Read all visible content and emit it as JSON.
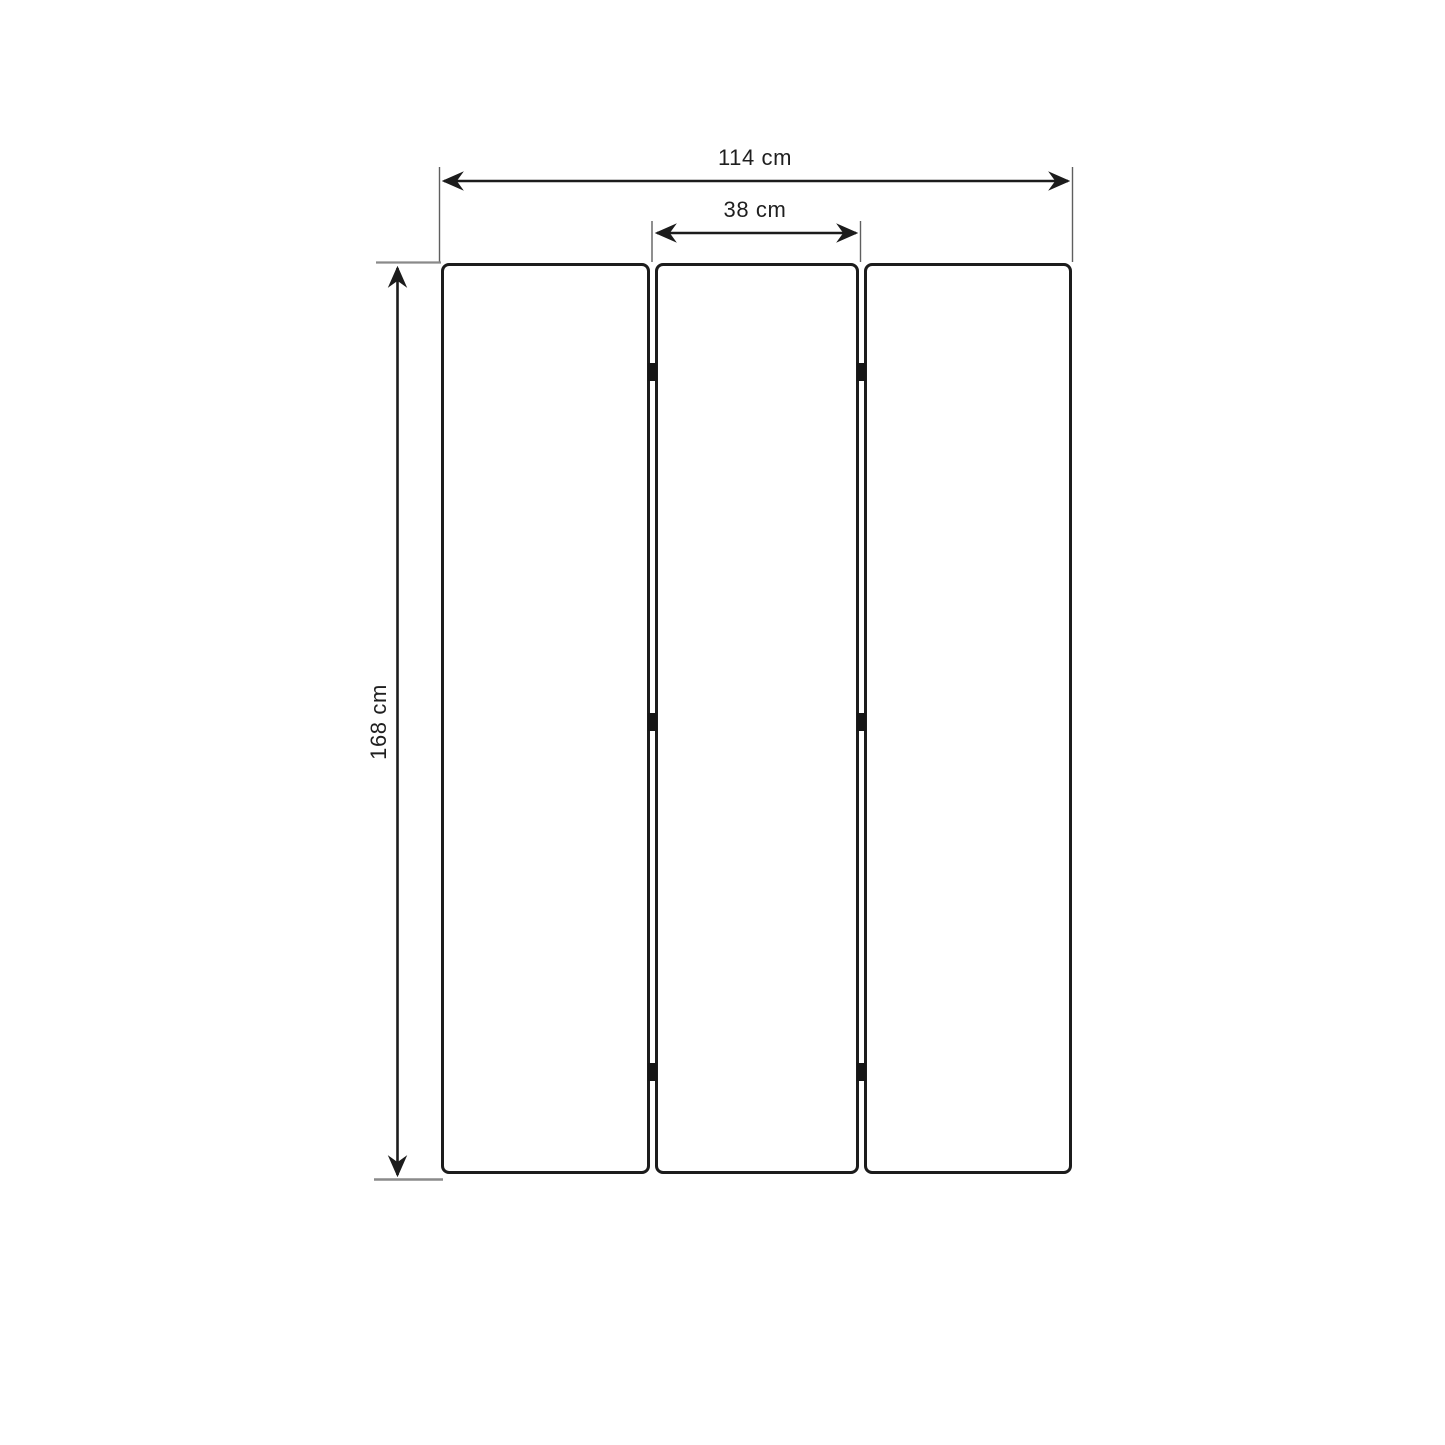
{
  "diagram": {
    "type": "dimension-drawing",
    "subject": "three-panel folding screen front view",
    "panel_count": 3,
    "hinge_rows": 3,
    "labels": {
      "total_width": "114 cm",
      "panel_width": "38 cm",
      "height": "168 cm"
    },
    "values_cm": {
      "total_width": 114,
      "panel_width": 38,
      "height": 168
    },
    "colors": {
      "line": "#1c1c1c",
      "extension_line": "#5f5f5f",
      "tick_line": "#8a8a8a",
      "panel_border": "#1c1c1c",
      "hinge": "#151515",
      "background": "#ffffff"
    }
  }
}
